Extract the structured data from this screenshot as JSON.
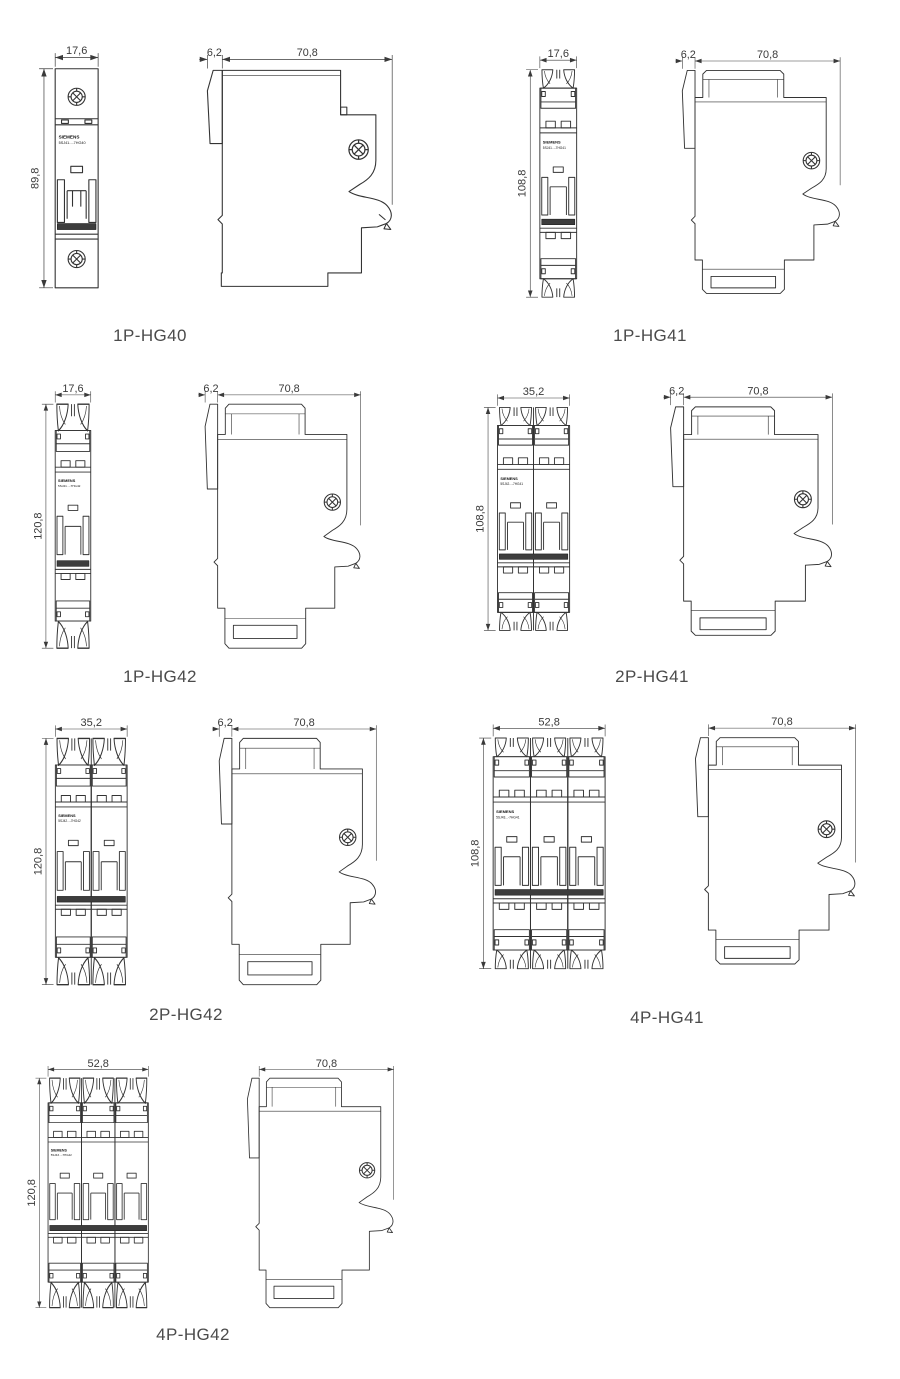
{
  "page": {
    "background_color": "#ffffff",
    "line_color": "#333333",
    "dimension_text_color": "#3a3a3a",
    "caption_color": "#4b4b4b",
    "toggle_bar_color": "#3d3d3d"
  },
  "figures": [
    {
      "id": "1p-hg40",
      "caption": "1P-HG40",
      "front_width": "17,6",
      "front_height": "89,8",
      "side_offset": "6,2",
      "side_depth": "70,8",
      "brand": "SIEMENS",
      "model": "5SJ41...-7HG40"
    },
    {
      "id": "1p-hg41",
      "caption": "1P-HG41",
      "front_width": "17,6",
      "front_height": "108,8",
      "side_offset": "6,2",
      "side_depth": "70,8",
      "brand": "SIEMENS",
      "model": "5SJ41...-7HG41"
    },
    {
      "id": "1p-hg42",
      "caption": "1P-HG42",
      "front_width": "17,6",
      "front_height": "120,8",
      "side_offset": "6,2",
      "side_depth": "70,8",
      "brand": "SIEMENS",
      "model": "5SJ41...-7HG42"
    },
    {
      "id": "2p-hg41",
      "caption": "2P-HG41",
      "front_width": "35,2",
      "front_height": "108,8",
      "side_offset": "6,2",
      "side_depth": "70,8",
      "brand": "SIEMENS",
      "model": "5SJ42...-7HG41"
    },
    {
      "id": "2p-hg42",
      "caption": "2P-HG42",
      "front_width": "35,2",
      "front_height": "120,8",
      "side_offset": "6,2",
      "side_depth": "70,8",
      "brand": "SIEMENS",
      "model": "5SJ42...-7HG42"
    },
    {
      "id": "4p-hg41",
      "caption": "4P-HG41",
      "front_width": "52,8",
      "front_height": "108,8",
      "side_depth": "70,8",
      "brand": "SIEMENS",
      "model": "5SJ43...-7HG41"
    },
    {
      "id": "4p-hg42",
      "caption": "4P-HG42",
      "front_width": "52,8",
      "front_height": "120,8",
      "side_depth": "70,8",
      "brand": "SIEMENS",
      "model": "5SJ43...-7HG42"
    }
  ]
}
